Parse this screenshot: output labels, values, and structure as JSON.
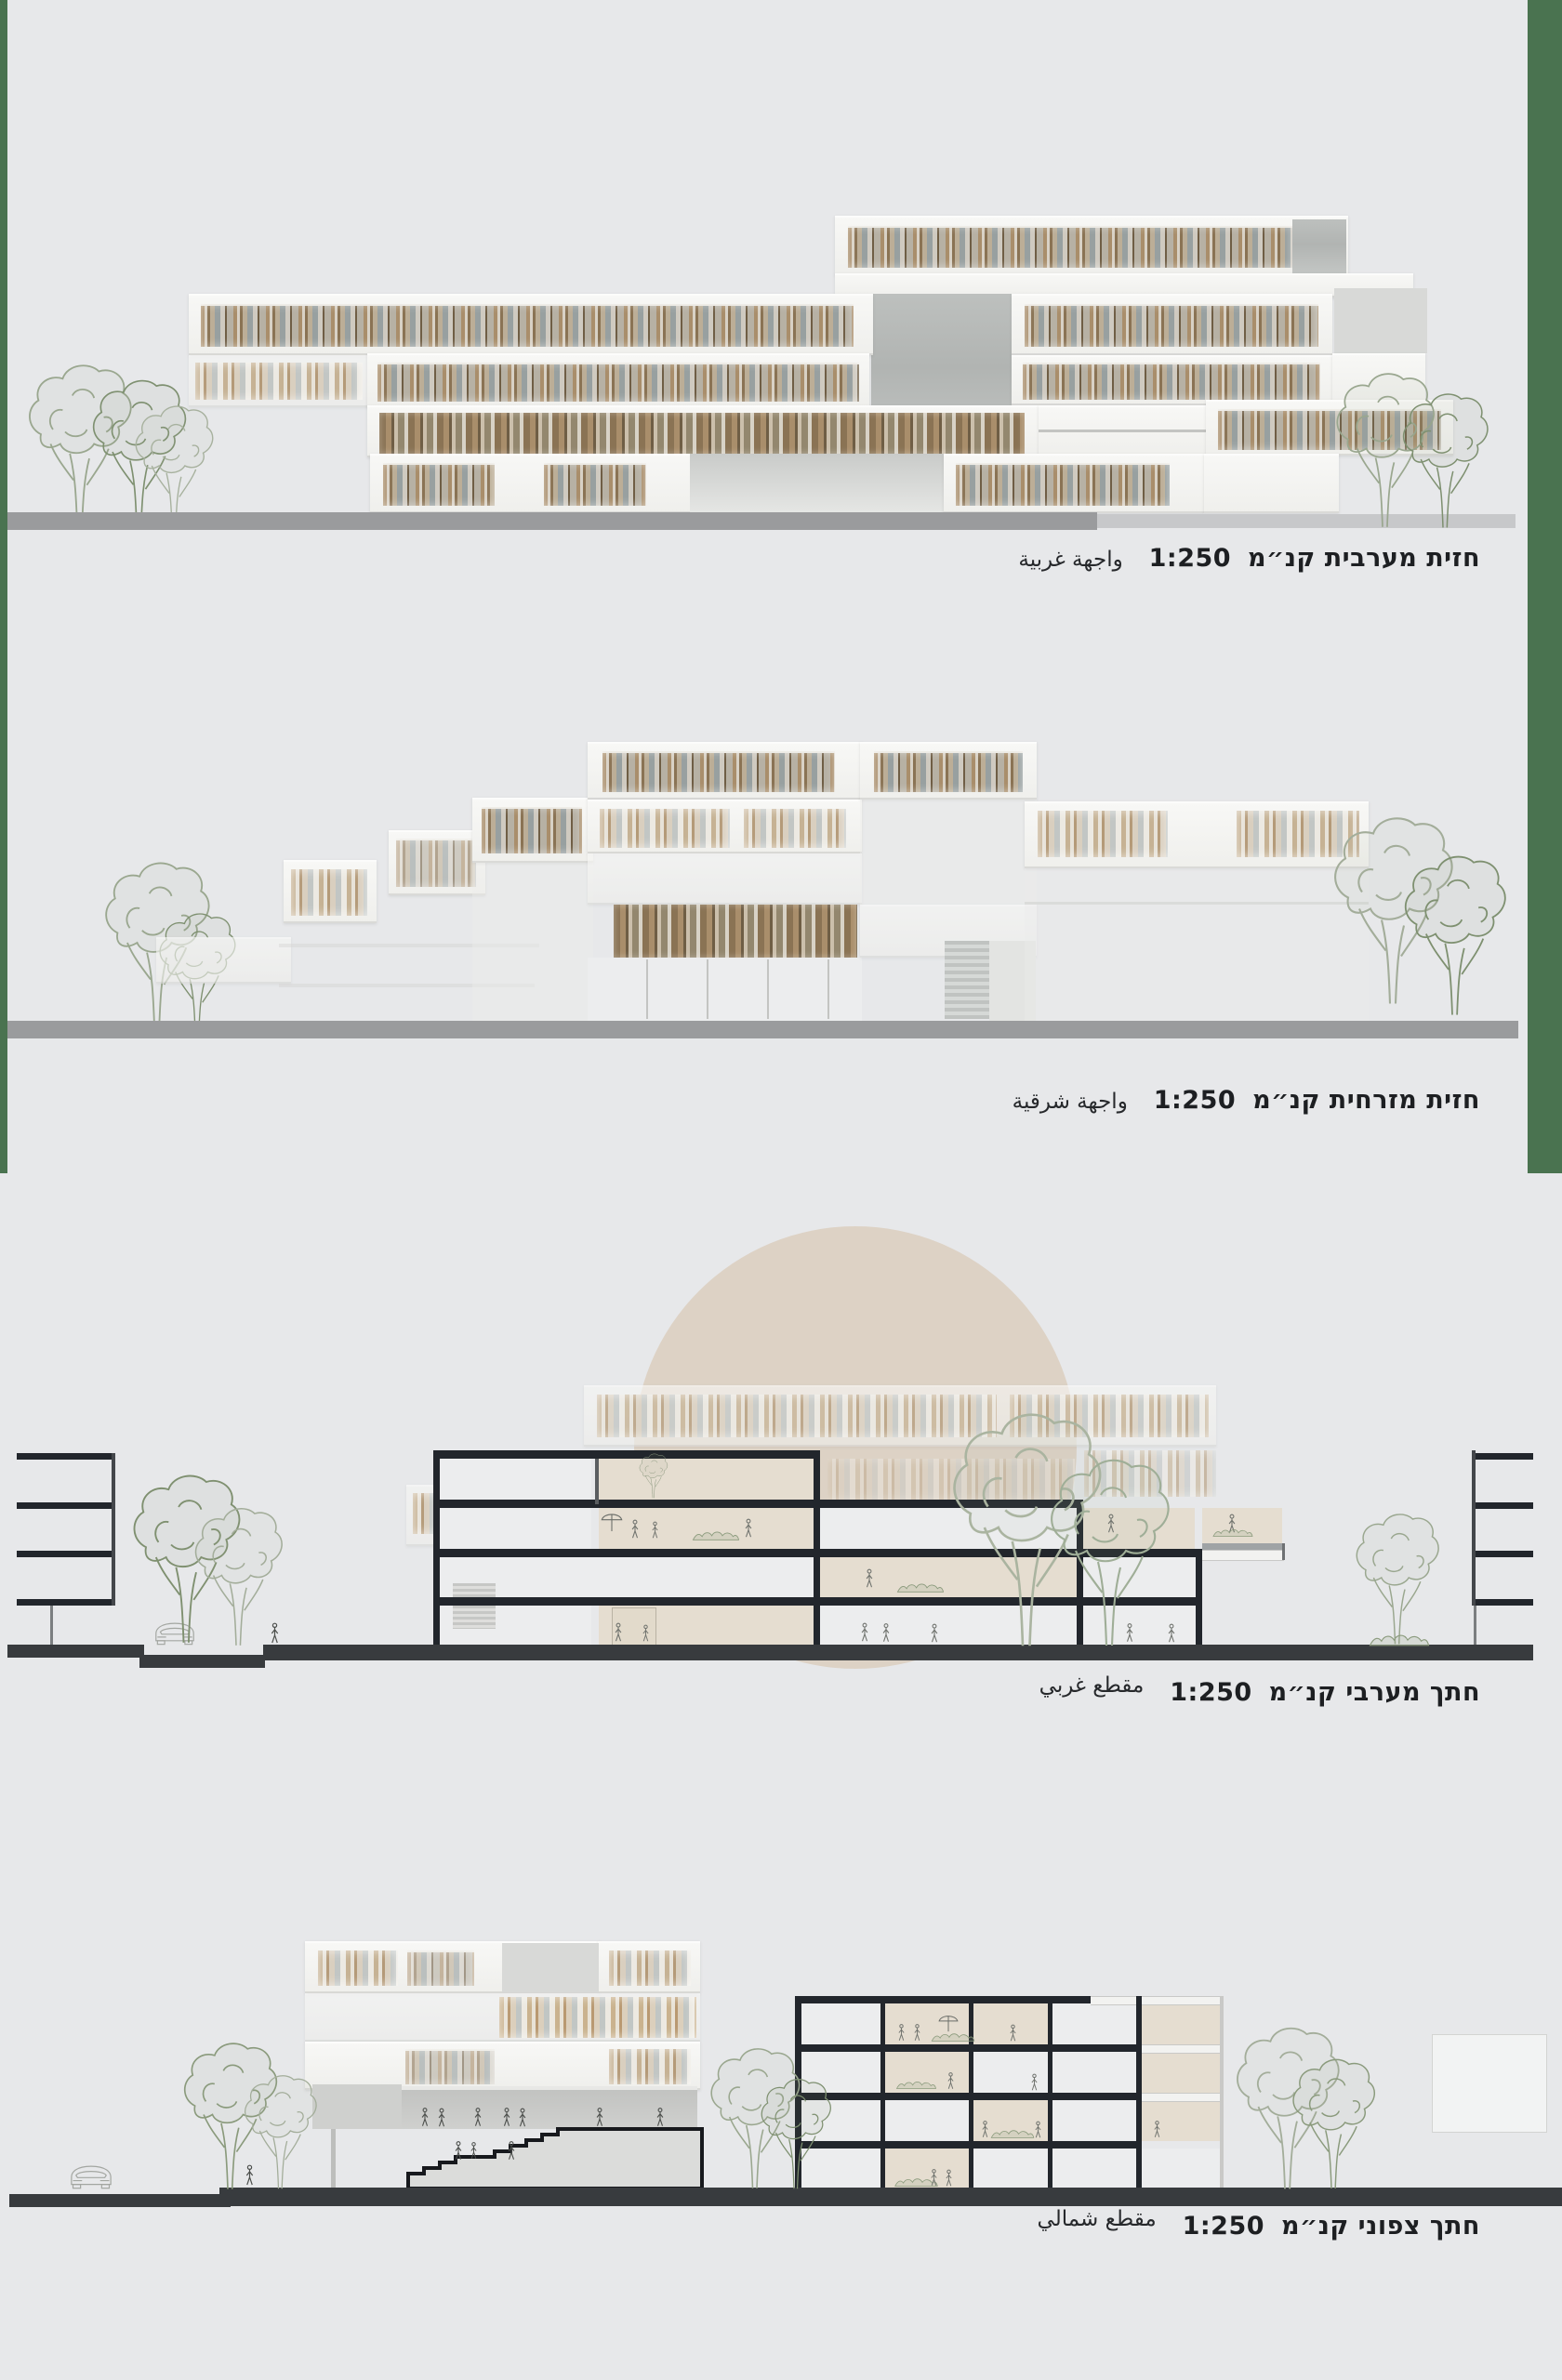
{
  "sheet": {
    "type": "architectural-presentation-board",
    "panels": [
      {
        "id": "west-elevation",
        "title_he": "חזית מערבית קנ״מ",
        "scale": "1:250",
        "title_ar": "واجهة غربية"
      },
      {
        "id": "east-elevation",
        "title_he": "חזית מזרחית קנ״מ",
        "scale": "1:250",
        "title_ar": "واجهة شرقية"
      },
      {
        "id": "west-section",
        "title_he": "חתך מערבי קנ״מ",
        "scale": "1:250",
        "title_ar": "مقطع غربي"
      },
      {
        "id": "north-section",
        "title_he": "חתך צפוני קנ״מ",
        "scale": "1:250",
        "title_ar": "مقطع شمالي"
      }
    ],
    "colors": {
      "background": "#e7e8ea",
      "green_margin": "#4a7350",
      "ground_gray": "#9a9b9d",
      "ground_dark": "#383b3e",
      "slab_black": "#22262c",
      "sun_circle_beige": "#ddd2c5",
      "interior_beige": "#e5ddd0",
      "wood_slat_tan": "#a98e6b",
      "wood_slat_dark": "#6f5e45",
      "glass_gray": "#98a0a0",
      "tree_sketch": "#8a9a7c"
    }
  }
}
